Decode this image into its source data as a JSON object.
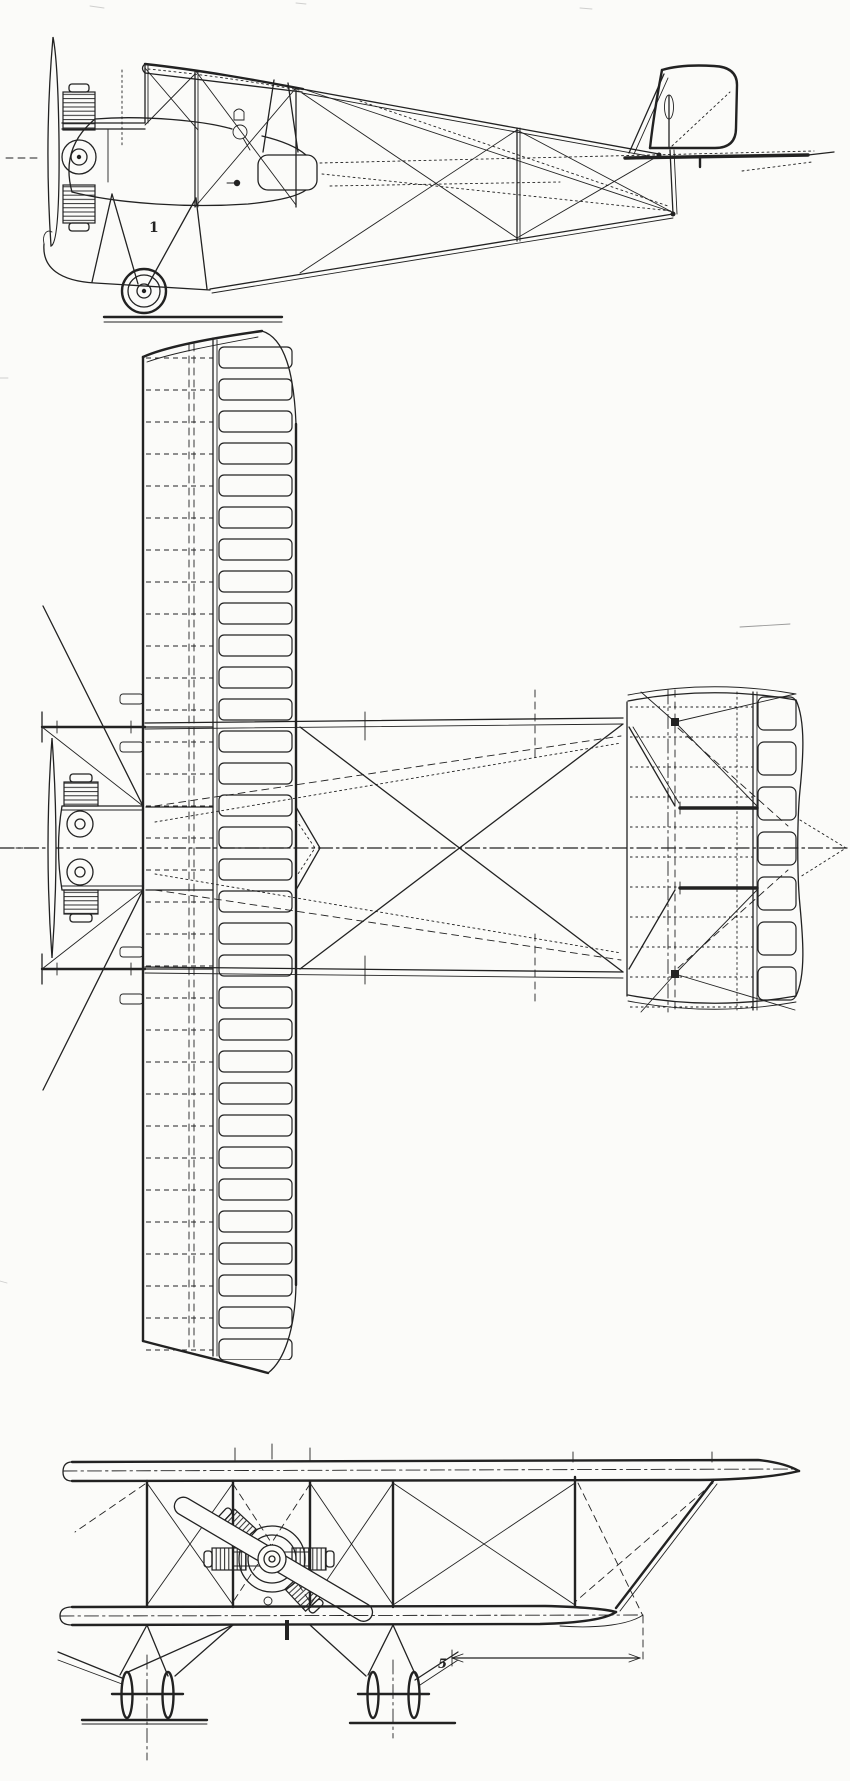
{
  "figure": {
    "background": "#fbfbf9",
    "ink": "#222222",
    "faint": "#9a9a9a"
  },
  "annotations": {
    "side_view_part_label": {
      "text": "1"
    },
    "front_view_dimension_label": {
      "text": "5"
    }
  }
}
